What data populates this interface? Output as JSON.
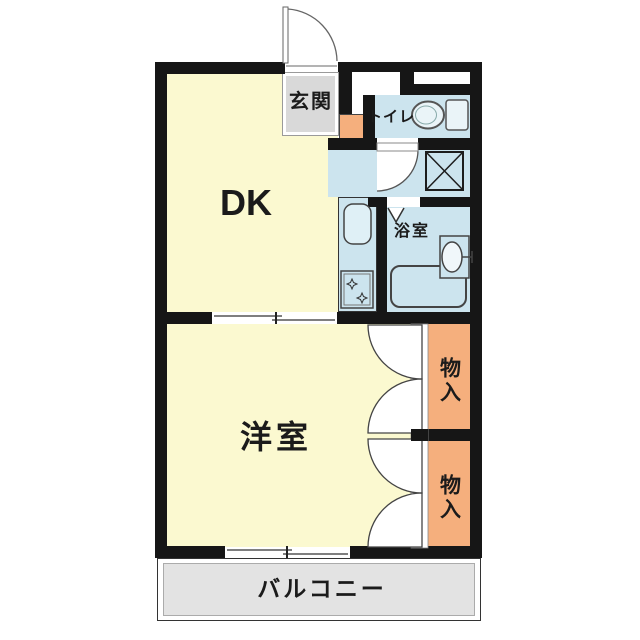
{
  "title": "1DK apartment floor plan",
  "rooms": {
    "entrance": {
      "label": "玄関"
    },
    "toilet": {
      "label": "トイレ"
    },
    "bathroom": {
      "label": "浴室"
    },
    "dining_kitchen": {
      "label": "DK"
    },
    "western_room": {
      "label": "洋室"
    },
    "storage_upper": {
      "label": "物入"
    },
    "storage_lower": {
      "label": "物入"
    },
    "balcony": {
      "label": "バルコニー"
    }
  },
  "fixtures": [
    "entrance-swing-door",
    "toilet-bowl-and-tank",
    "washing-machine-pan",
    "washroom-swing-door",
    "bathroom-folding-door",
    "bathtub",
    "washbasin",
    "kitchen-sink",
    "stove-with-burners",
    "sliding-door-dk-room",
    "sliding-window-balcony",
    "closet-double-doors-upper",
    "closet-double-doors-lower"
  ],
  "colors": {
    "wall": "#161616",
    "room_yellow": "#FBF9D0",
    "wet_area_blue": "#CCE4EE",
    "accent_orange": "#F5AF7D",
    "entrance_gray": "#D9D9D9",
    "balcony_gray": "#E3E3E3"
  }
}
